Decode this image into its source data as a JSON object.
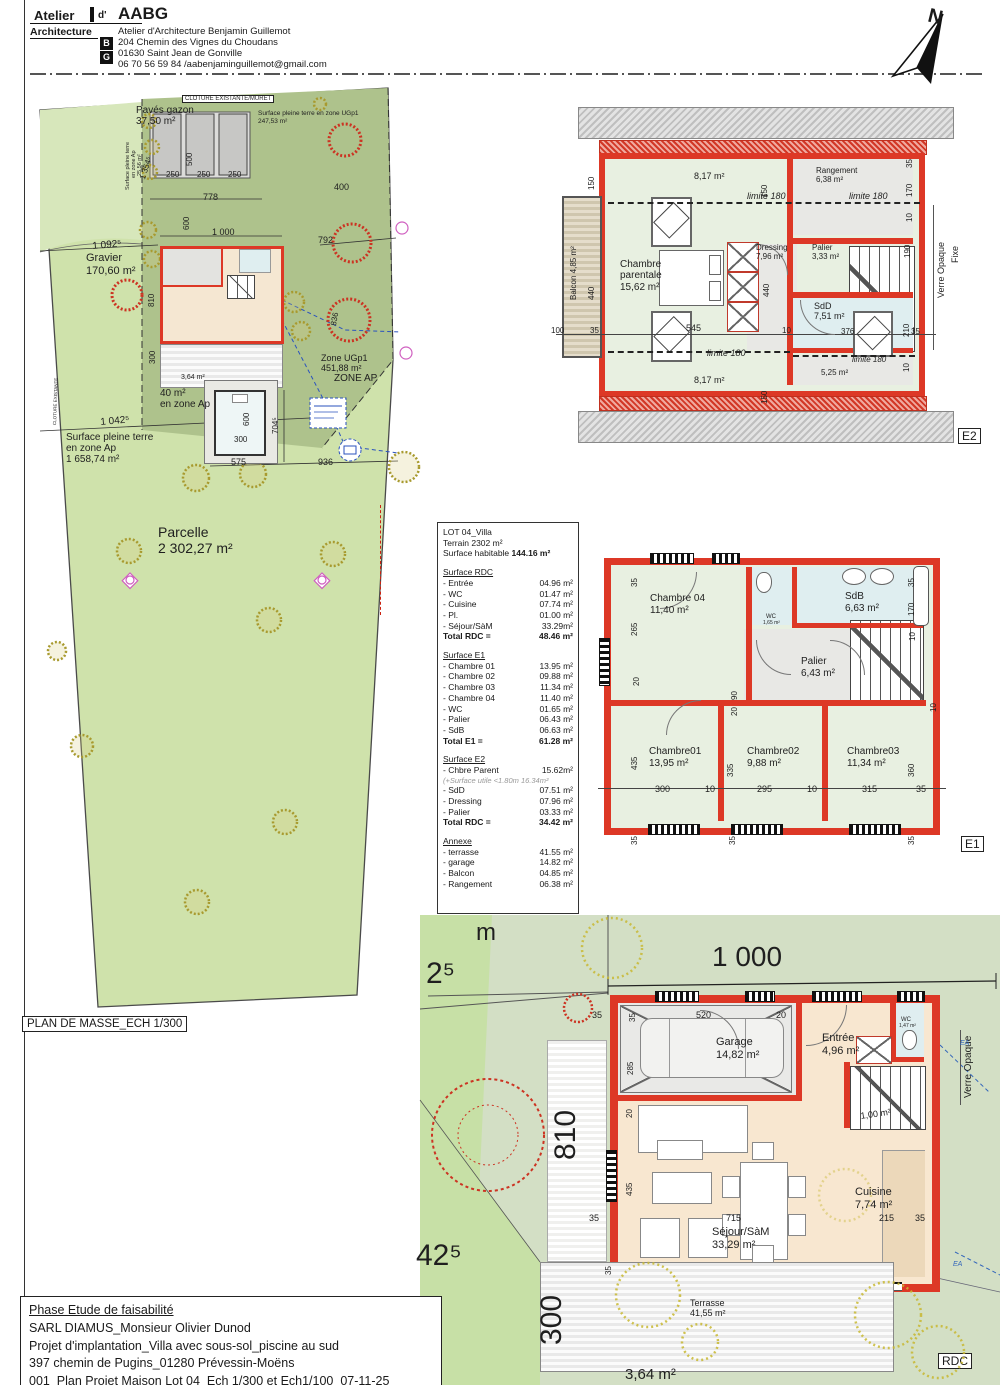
{
  "header": {
    "atelier": "Atelier",
    "d": "d'",
    "brand": "AABG",
    "architecture": "Architecture",
    "firm": "Atelier d'Architecture Benjamin Guillemot",
    "address1": "204 Chemin des Vignes du Choudans",
    "address2": "01630 Saint Jean de Gonville",
    "contact": "06 70 56 59 84 /aabenjaminguillemot@gmail.com",
    "logo_b": "B",
    "logo_g": "G"
  },
  "north": {
    "label": "N"
  },
  "site_plan": {
    "title": "PLAN DE MASSE_ECH 1/300",
    "labels": [
      {
        "t": "CLOTURE EXISTANTE/MURET",
        "x": 182,
        "y": 95,
        "s": 6,
        "bx": 1
      },
      {
        "t": "Pavés gazon",
        "x": 136,
        "y": 106,
        "s": 10
      },
      {
        "t": "37,50 m²",
        "x": 136,
        "y": 117,
        "s": 10
      },
      {
        "t": "Surface pleine terre en zone UGp1",
        "x": 258,
        "y": 111,
        "s": 6.5
      },
      {
        "t": "247,53 m²",
        "x": 258,
        "y": 119,
        "s": 6.5
      },
      {
        "t": "Surface pleine terre",
        "x": 126,
        "y": 190,
        "s": 5.5,
        "r": -90
      },
      {
        "t": "en zone Ap",
        "x": 132,
        "y": 178,
        "s": 5.5,
        "r": -90
      },
      {
        "t": "25,56 m²",
        "x": 138,
        "y": 176,
        "s": 5.5,
        "r": -90
      },
      {
        "t": "1 354⁵",
        "x": 139,
        "y": 178,
        "s": 8,
        "r": -72
      },
      {
        "t": "250",
        "x": 166,
        "y": 171,
        "s": 8
      },
      {
        "t": "250",
        "x": 197,
        "y": 171,
        "s": 8
      },
      {
        "t": "250",
        "x": 228,
        "y": 171,
        "s": 8
      },
      {
        "t": "500",
        "x": 186,
        "y": 166,
        "s": 8,
        "r": -90
      },
      {
        "t": "778",
        "x": 203,
        "y": 193,
        "s": 9
      },
      {
        "t": "600",
        "x": 183,
        "y": 230,
        "s": 8,
        "r": -90
      },
      {
        "t": "1 000",
        "x": 212,
        "y": 228,
        "s": 9
      },
      {
        "t": "792",
        "x": 318,
        "y": 236,
        "s": 9
      },
      {
        "t": "400",
        "x": 334,
        "y": 183,
        "s": 9
      },
      {
        "t": "Gravier",
        "x": 86,
        "y": 253,
        "s": 11
      },
      {
        "t": "170,60 m²",
        "x": 86,
        "y": 266,
        "s": 11
      },
      {
        "t": "1 092⁵",
        "x": 92,
        "y": 242,
        "s": 10,
        "r": -5
      },
      {
        "t": "810",
        "x": 148,
        "y": 307,
        "s": 8,
        "r": -90
      },
      {
        "t": "836",
        "x": 330,
        "y": 325,
        "s": 8,
        "r": -80
      },
      {
        "t": "1 042⁵",
        "x": 100,
        "y": 418,
        "s": 10,
        "r": -5
      },
      {
        "t": "300",
        "x": 149,
        "y": 364,
        "s": 8,
        "r": -90
      },
      {
        "t": "3,64 m²",
        "x": 181,
        "y": 374,
        "s": 7
      },
      {
        "t": "Zone UGp1",
        "x": 321,
        "y": 354,
        "s": 9
      },
      {
        "t": "451,88 m²",
        "x": 321,
        "y": 364,
        "s": 9
      },
      {
        "t": "ZONE AP",
        "x": 334,
        "y": 374,
        "s": 10
      },
      {
        "t": "40 m²",
        "x": 160,
        "y": 389,
        "s": 10
      },
      {
        "t": "en zone Ap",
        "x": 160,
        "y": 400,
        "s": 10
      },
      {
        "t": "600",
        "x": 243,
        "y": 426,
        "s": 8,
        "r": -90
      },
      {
        "t": "300",
        "x": 234,
        "y": 436,
        "s": 8
      },
      {
        "t": "704⁵",
        "x": 272,
        "y": 434,
        "s": 8,
        "r": -90
      },
      {
        "t": "575",
        "x": 231,
        "y": 458,
        "s": 9
      },
      {
        "t": "936",
        "x": 318,
        "y": 458,
        "s": 9
      },
      {
        "t": "Surface pleine terre",
        "x": 66,
        "y": 433,
        "s": 10
      },
      {
        "t": "en zone Ap",
        "x": 66,
        "y": 444,
        "s": 10
      },
      {
        "t": "1 658,74 m²",
        "x": 66,
        "y": 455,
        "s": 10
      },
      {
        "t": "Parcelle",
        "x": 158,
        "y": 525,
        "s": 14,
        "n": "parcel-label"
      },
      {
        "t": "2 302,27 m²",
        "x": 158,
        "y": 541,
        "s": 14,
        "n": "parcel-area"
      },
      {
        "t": "CLOTURE EXISTANTE",
        "x": 53,
        "y": 425,
        "s": 4.5,
        "r": -88
      }
    ]
  },
  "surface_table": {
    "lot": "LOT 04_Villa",
    "terrain": "Terrain 2302 m²",
    "habitable_label": "Surface habitable",
    "habitable_value": "144.16 m²",
    "sections": [
      {
        "h": "Surface RDC",
        "rows": [
          {
            "l": "- Entrée",
            "v": "04.96 m²"
          },
          {
            "l": "- WC",
            "v": "01.47 m²"
          },
          {
            "l": "- Cuisine",
            "v": "07.74 m²"
          },
          {
            "l": "- Pl.",
            "v": "01.00 m²"
          },
          {
            "l": "- Séjour/SàM",
            "v": "33.29m²"
          }
        ],
        "total": {
          "l": "Total RDC =",
          "v": "48.46 m²"
        }
      },
      {
        "h": "Surface E1",
        "rows": [
          {
            "l": "- Chambre 01",
            "v": "13.95 m²"
          },
          {
            "l": "- Chambre 02",
            "v": "09.88 m²"
          },
          {
            "l": "- Chambre 03",
            "v": "11.34 m²"
          },
          {
            "l": "- Chambre 04",
            "v": "11.40 m²"
          },
          {
            "l": "- WC",
            "v": "01.65 m²"
          },
          {
            "l": "- Palier",
            "v": "06.43 m²"
          },
          {
            "l": "- SdB",
            "v": "06.63 m²"
          }
        ],
        "total": {
          "l": "Total E1 =",
          "v": "61.28 m²"
        }
      },
      {
        "h": "Surface E2",
        "rows": [
          {
            "l": "- Chbre Parent",
            "v": "15.62m²"
          },
          {
            "note": "(+Surface utile <1.80m 16.34m²"
          },
          {
            "l": "- SdD",
            "v": "07.51 m²"
          },
          {
            "l": "- Dressing",
            "v": "07.96 m²"
          },
          {
            "l": "- Palier",
            "v": "03.33 m²"
          }
        ],
        "total": {
          "l": "Total RDC =",
          "v": "34.42 m²"
        }
      },
      {
        "h": "Annexe",
        "rows": [
          {
            "l": "- terrasse",
            "v": "41.55 m²"
          },
          {
            "l": "- garage",
            "v": "14.82 m²"
          },
          {
            "l": "- Balcon",
            "v": "04.85 m²"
          },
          {
            "l": "- Rangement",
            "v": "06.38 m²"
          }
        ],
        "total": null
      }
    ]
  },
  "e2": {
    "tag": "E2",
    "labels": [
      {
        "t": "8,17 m²",
        "x": 694,
        "y": 172,
        "s": 9
      },
      {
        "t": "limite 180",
        "x": 747,
        "y": 192,
        "s": 9,
        "i": 1
      },
      {
        "t": "150",
        "x": 761,
        "y": 198,
        "s": 8,
        "r": -90
      },
      {
        "t": "Rangement",
        "x": 816,
        "y": 167,
        "s": 8
      },
      {
        "t": "6,38 m²",
        "x": 816,
        "y": 176,
        "s": 8
      },
      {
        "t": "limite 180",
        "x": 849,
        "y": 192,
        "s": 9,
        "i": 1
      },
      {
        "t": "35",
        "x": 906,
        "y": 168,
        "s": 8,
        "r": -90
      },
      {
        "t": "170",
        "x": 906,
        "y": 197,
        "s": 8,
        "r": -90
      },
      {
        "t": "10",
        "x": 906,
        "y": 222,
        "s": 8,
        "r": -90
      },
      {
        "t": "190",
        "x": 904,
        "y": 258,
        "s": 8,
        "r": -90
      },
      {
        "t": "Balcon 4,85 m²",
        "x": 570,
        "y": 300,
        "s": 8,
        "r": -90
      },
      {
        "t": "Chambre",
        "x": 620,
        "y": 260,
        "s": 10
      },
      {
        "t": "parentale",
        "x": 620,
        "y": 271,
        "s": 10
      },
      {
        "t": "15,62 m²",
        "x": 620,
        "y": 283,
        "s": 10
      },
      {
        "t": "Dressing",
        "x": 756,
        "y": 244,
        "s": 8
      },
      {
        "t": "7,96 m²",
        "x": 756,
        "y": 253,
        "s": 8
      },
      {
        "t": "440",
        "x": 763,
        "y": 297,
        "s": 8,
        "r": -90
      },
      {
        "t": "Palier",
        "x": 812,
        "y": 244,
        "s": 8
      },
      {
        "t": "3,33 m²",
        "x": 812,
        "y": 253,
        "s": 8
      },
      {
        "t": "100",
        "x": 551,
        "y": 327,
        "s": 8
      },
      {
        "t": "35",
        "x": 590,
        "y": 327,
        "s": 8
      },
      {
        "t": "545",
        "x": 686,
        "y": 324,
        "s": 9
      },
      {
        "t": "10",
        "x": 782,
        "y": 327,
        "s": 8
      },
      {
        "t": "limite 180",
        "x": 707,
        "y": 349,
        "s": 9,
        "i": 1
      },
      {
        "t": "150",
        "x": 761,
        "y": 404,
        "s": 8,
        "r": -90
      },
      {
        "t": "8,17 m²",
        "x": 694,
        "y": 376,
        "s": 9
      },
      {
        "t": "SdD",
        "x": 814,
        "y": 302,
        "s": 9
      },
      {
        "t": "7,51 m²",
        "x": 814,
        "y": 312,
        "s": 9
      },
      {
        "t": "376",
        "x": 841,
        "y": 328,
        "s": 8
      },
      {
        "t": "35",
        "x": 911,
        "y": 328,
        "s": 8
      },
      {
        "t": "210",
        "x": 903,
        "y": 337,
        "s": 8,
        "r": -90
      },
      {
        "t": "10",
        "x": 903,
        "y": 372,
        "s": 8,
        "r": -90
      },
      {
        "t": "limite 180",
        "x": 852,
        "y": 356,
        "s": 8,
        "i": 1
      },
      {
        "t": "5,25 m²",
        "x": 821,
        "y": 369,
        "s": 8
      },
      {
        "t": "150",
        "x": 588,
        "y": 190,
        "s": 8,
        "r": -90
      },
      {
        "t": "440",
        "x": 588,
        "y": 300,
        "s": 8,
        "r": -90
      },
      {
        "t": "Verre Opaque",
        "x": 937,
        "y": 298,
        "s": 9,
        "r": -90
      },
      {
        "t": "Fixe",
        "x": 951,
        "y": 263,
        "s": 9,
        "r": -90
      }
    ]
  },
  "e1": {
    "tag": "E1",
    "labels": [
      {
        "t": "Chambre 04",
        "x": 650,
        "y": 594,
        "s": 10
      },
      {
        "t": "11,40 m²",
        "x": 650,
        "y": 606,
        "s": 10
      },
      {
        "t": "WC",
        "x": 766,
        "y": 614,
        "s": 6
      },
      {
        "t": "1,65 m²",
        "x": 763,
        "y": 621,
        "s": 5
      },
      {
        "t": "SdB",
        "x": 845,
        "y": 592,
        "s": 10
      },
      {
        "t": "6,63 m²",
        "x": 845,
        "y": 604,
        "s": 10
      },
      {
        "t": "Palier",
        "x": 801,
        "y": 657,
        "s": 10
      },
      {
        "t": "6,43 m²",
        "x": 801,
        "y": 669,
        "s": 10
      },
      {
        "t": "Chambre01",
        "x": 649,
        "y": 747,
        "s": 10
      },
      {
        "t": "13,95 m²",
        "x": 649,
        "y": 759,
        "s": 10
      },
      {
        "t": "Chambre02",
        "x": 747,
        "y": 747,
        "s": 10
      },
      {
        "t": "9,88 m²",
        "x": 747,
        "y": 759,
        "s": 10
      },
      {
        "t": "Chambre03",
        "x": 847,
        "y": 747,
        "s": 10
      },
      {
        "t": "11,34 m²",
        "x": 847,
        "y": 759,
        "s": 10
      },
      {
        "t": "35",
        "x": 631,
        "y": 587,
        "s": 8,
        "r": -90
      },
      {
        "t": "265",
        "x": 631,
        "y": 636,
        "s": 8,
        "r": -90
      },
      {
        "t": "20",
        "x": 633,
        "y": 686,
        "s": 8,
        "r": -90
      },
      {
        "t": "90",
        "x": 731,
        "y": 700,
        "s": 8,
        "r": -90
      },
      {
        "t": "20",
        "x": 731,
        "y": 716,
        "s": 8,
        "r": -90
      },
      {
        "t": "35",
        "x": 908,
        "y": 587,
        "s": 8,
        "r": -90
      },
      {
        "t": "170",
        "x": 908,
        "y": 616,
        "s": 8,
        "r": -90
      },
      {
        "t": "10",
        "x": 909,
        "y": 641,
        "s": 8,
        "r": -90
      },
      {
        "t": "10",
        "x": 930,
        "y": 712,
        "s": 8,
        "r": -90
      },
      {
        "t": "435",
        "x": 631,
        "y": 770,
        "s": 8,
        "r": -90
      },
      {
        "t": "335",
        "x": 727,
        "y": 777,
        "s": 8,
        "r": -90
      },
      {
        "t": "360",
        "x": 908,
        "y": 777,
        "s": 8,
        "r": -90
      },
      {
        "t": "300",
        "x": 655,
        "y": 785,
        "s": 9
      },
      {
        "t": "10",
        "x": 705,
        "y": 785,
        "s": 9
      },
      {
        "t": "295",
        "x": 757,
        "y": 785,
        "s": 9
      },
      {
        "t": "10",
        "x": 807,
        "y": 785,
        "s": 9
      },
      {
        "t": "315",
        "x": 862,
        "y": 785,
        "s": 9
      },
      {
        "t": "35",
        "x": 916,
        "y": 785,
        "s": 9
      },
      {
        "t": "35",
        "x": 631,
        "y": 845,
        "s": 8,
        "r": -90
      },
      {
        "t": "35",
        "x": 729,
        "y": 845,
        "s": 8,
        "r": -90
      },
      {
        "t": "35",
        "x": 908,
        "y": 845,
        "s": 8,
        "r": -90
      }
    ]
  },
  "rdc": {
    "tag": "RDC",
    "labels": [
      {
        "t": "1 000",
        "x": 712,
        "y": 942,
        "s": 28
      },
      {
        "t": "m",
        "x": 476,
        "y": 920,
        "s": 24
      },
      {
        "t": "2⁵",
        "x": 426,
        "y": 958,
        "s": 30
      },
      {
        "t": "42⁵",
        "x": 416,
        "y": 1240,
        "s": 30
      },
      {
        "t": "810",
        "x": 550,
        "y": 1160,
        "s": 30,
        "r": -90
      },
      {
        "t": "300",
        "x": 536,
        "y": 1345,
        "s": 30,
        "r": -90
      },
      {
        "t": "35",
        "x": 592,
        "y": 1011,
        "s": 9
      },
      {
        "t": "35",
        "x": 629,
        "y": 1022,
        "s": 8,
        "r": -90
      },
      {
        "t": "520",
        "x": 696,
        "y": 1011,
        "s": 9
      },
      {
        "t": "20",
        "x": 776,
        "y": 1011,
        "s": 9
      },
      {
        "t": "285",
        "x": 627,
        "y": 1075,
        "s": 8,
        "r": -90
      },
      {
        "t": "Garage",
        "x": 716,
        "y": 1037,
        "s": 11
      },
      {
        "t": "14,82 m²",
        "x": 716,
        "y": 1050,
        "s": 11
      },
      {
        "t": "Entrée",
        "x": 822,
        "y": 1033,
        "s": 11
      },
      {
        "t": "4,96 m²",
        "x": 822,
        "y": 1046,
        "s": 11
      },
      {
        "t": "WC",
        "x": 901,
        "y": 1017,
        "s": 6
      },
      {
        "t": "1,47 m²",
        "x": 899,
        "y": 1024,
        "s": 5
      },
      {
        "t": "Verre Opaque",
        "x": 964,
        "y": 1098,
        "s": 10,
        "r": -90
      },
      {
        "t": "1,00 m²",
        "x": 860,
        "y": 1112,
        "s": 9,
        "r": -8
      },
      {
        "t": "20",
        "x": 626,
        "y": 1118,
        "s": 8,
        "r": -90
      },
      {
        "t": "435",
        "x": 626,
        "y": 1196,
        "s": 8,
        "r": -90
      },
      {
        "t": "Cuisine",
        "x": 855,
        "y": 1187,
        "s": 11
      },
      {
        "t": "7,74 m²",
        "x": 855,
        "y": 1200,
        "s": 11
      },
      {
        "t": "715",
        "x": 726,
        "y": 1214,
        "s": 9
      },
      {
        "t": "215",
        "x": 879,
        "y": 1214,
        "s": 9
      },
      {
        "t": "35",
        "x": 915,
        "y": 1214,
        "s": 9
      },
      {
        "t": "35",
        "x": 589,
        "y": 1214,
        "s": 9
      },
      {
        "t": "Séjour/SàM",
        "x": 712,
        "y": 1227,
        "s": 11
      },
      {
        "t": "33,29 m²",
        "x": 712,
        "y": 1240,
        "s": 11
      },
      {
        "t": "35",
        "x": 605,
        "y": 1275,
        "s": 8,
        "r": -90
      },
      {
        "t": "Terrasse",
        "x": 690,
        "y": 1299,
        "s": 9
      },
      {
        "t": "41,55 m²",
        "x": 690,
        "y": 1309,
        "s": 9
      },
      {
        "t": "3,64 m²",
        "x": 625,
        "y": 1367,
        "s": 15
      },
      {
        "t": "EA",
        "x": 953,
        "y": 1261,
        "s": 7,
        "c": "#3366bb",
        "i": 1
      },
      {
        "t": "EA",
        "x": 960,
        "y": 1040,
        "s": 7,
        "c": "#3366bb",
        "i": 1
      }
    ]
  },
  "footer": {
    "lines": [
      "Phase Etude de faisabilité",
      "SARL DIAMUS_Monsieur Olivier Dunod",
      "Projet d'implantation_Villa avec sous-sol_piscine au sud",
      "397 chemin de Pugins_01280 Prévessin-Moëns",
      "001_Plan Projet Maison Lot 04_Ech 1/300 et Ech1/100_07-11-25"
    ]
  },
  "colors": {
    "wall_red": "#dd3826",
    "parcel_green": "#cfe2ab",
    "zone_dark_green": "#aec28c",
    "room_green": "#e8f0e1",
    "room_blue": "#dfeef0",
    "room_beige": "#f8e7d0",
    "utility_blue": "#2a52be"
  }
}
